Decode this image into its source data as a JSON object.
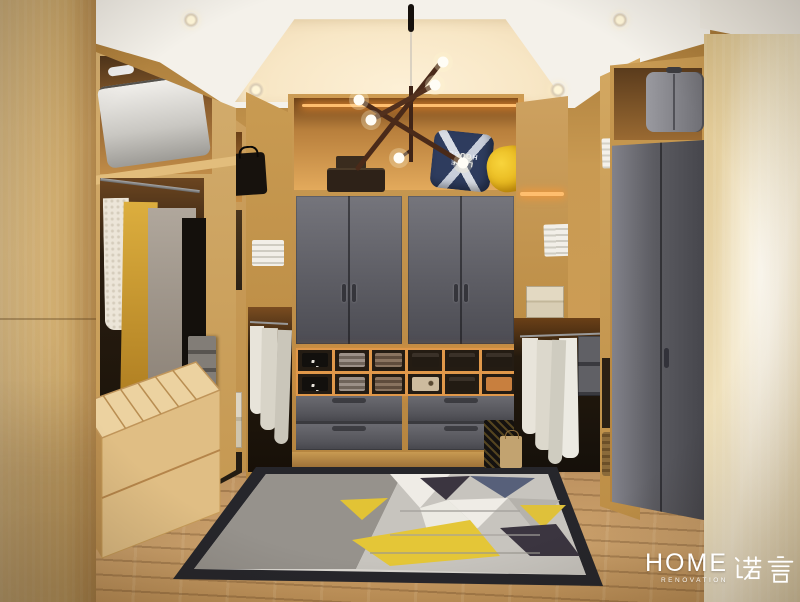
{
  "watermark": {
    "brand": "HOME",
    "sub": "RENOVATION",
    "cn": "诺言"
  },
  "pillow": {
    "line1": "LAKE",
    "line2": "HOUSE"
  },
  "scene": {
    "description": "Walk-in closet interior render: light wood shelving, gray wardrobe doors and drawers, hanging clothes, geometric rug, sputnik chandelier, warm cove ceiling lighting",
    "chandelier_bulbs": 6,
    "downlights": 6
  },
  "palette": {
    "wood_light": "#e0c28a",
    "wood_mid": "#c89a52",
    "wood_dark": "#a5763a",
    "cabinet_gray": "#63636a",
    "drawer_gray": "#5a5a60",
    "wardrobe_gray": "#54545a",
    "glow_orange": "#e89a4a",
    "ceiling_cream": "#f8ecd6",
    "ceiling_white": "#f4f1ea",
    "floor_wood": "#bd9260",
    "rug_field": "#dbd8d2",
    "rug_gray": "#96928c",
    "rug_yellow": "#e4c637",
    "rug_navy": "#57607a",
    "rug_dark": "#3b3540",
    "rug_border": "#26262b",
    "pillow_navy": "#2e3c5e",
    "pillow_yellow": "#f2c51d",
    "bulb_warm": "#fffdf6",
    "metal_bronze": "#4a2a19"
  }
}
